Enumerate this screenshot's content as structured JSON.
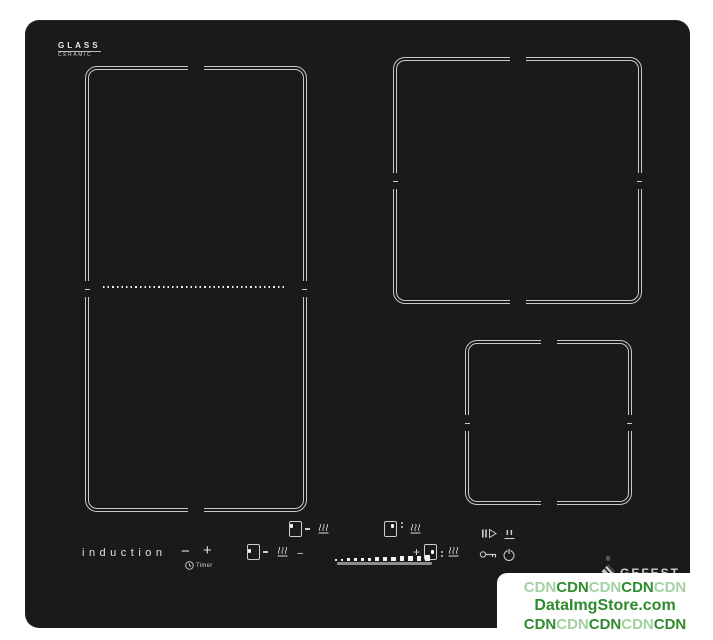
{
  "photo": {
    "glass_logo": {
      "line1": "GLASS",
      "line2": "CERAMIC"
    },
    "induction_label": "induction",
    "timer_label": "Timer",
    "symbols": {
      "minus": "−",
      "plus": "+",
      "registered": "®"
    },
    "brand": {
      "name": "GEFEST"
    },
    "slider": {
      "dot_count": 13
    },
    "colors": {
      "panel": "#1a1a1a",
      "line": "#c9c9c9",
      "wm_dark": "#2e8b2e",
      "wm_light": "#a5cfa5"
    }
  },
  "watermark": {
    "line1": {
      "segments": [
        {
          "text": "CDN",
          "cls": "wm-light"
        },
        {
          "text": "CDN",
          "cls": "wm-dark"
        },
        {
          "text": "CDN",
          "cls": "wm-light"
        },
        {
          "text": "CDN",
          "cls": "wm-dark"
        },
        {
          "text": "CDN",
          "cls": "wm-light"
        }
      ]
    },
    "line2": {
      "text": "DataImgStore.com"
    },
    "line3": {
      "segments": [
        {
          "text": "CDN",
          "cls": "wm-dark"
        },
        {
          "text": "CDN",
          "cls": "wm-light"
        },
        {
          "text": "CDN",
          "cls": "wm-dark"
        },
        {
          "text": "CDN",
          "cls": "wm-light"
        },
        {
          "text": "CDN",
          "cls": "wm-dark"
        }
      ]
    }
  }
}
